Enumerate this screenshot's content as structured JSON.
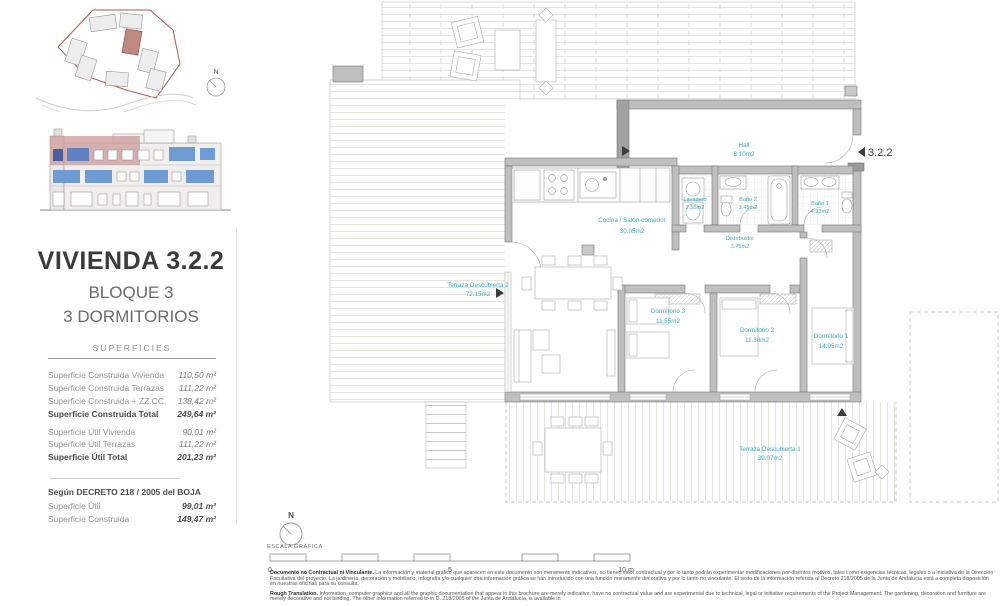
{
  "header": {
    "title": "VIVIENDA 3.2.2",
    "block": "BLOQUE 3",
    "bedrooms": "3 DORMITORIOS"
  },
  "superficies": {
    "heading": "SUPERFICIES",
    "construida": [
      {
        "label": "Superficie Construida Vivienda",
        "value": "110,50 m²"
      },
      {
        "label": "Superficie Construida Terrazas",
        "value": "111,22 m²"
      },
      {
        "label": "Superficie Construida + ZZ.CC.",
        "value": "138,42 m²"
      },
      {
        "label": "Superficie Construida Total",
        "value": "249,64 m²"
      }
    ],
    "util": [
      {
        "label": "Superficie Útil Vivienda",
        "value": "90,01 m²"
      },
      {
        "label": "Superficie Útil Terrazas",
        "value": "111,22 m²"
      },
      {
        "label": "Superficie Útil Total",
        "value": "201,23 m²"
      }
    ]
  },
  "decreto": {
    "heading": "Según DECRETO 218 / 2005 del BOJA",
    "rows": [
      {
        "label": "Superficie Útil",
        "value": "99,01 m²"
      },
      {
        "label": "Superficie Construida",
        "value": "149,47 m²"
      }
    ]
  },
  "plan": {
    "unit_marker": "3.2.2",
    "rooms": [
      {
        "name": "Terraza Descubierta 2",
        "area": "72.15m2"
      },
      {
        "name": "Cocina / Salón-comedor",
        "area": "30.05m2"
      },
      {
        "name": "Hall",
        "area": "8.10m2"
      },
      {
        "name": "Lavadero",
        "area": "2.55m2"
      },
      {
        "name": "Baño 2",
        "area": "3.45m2"
      },
      {
        "name": "Baño 1",
        "area": "4.23m2"
      },
      {
        "name": "Distribuidor",
        "area": "3.75m2"
      },
      {
        "name": "Dormitorio 3",
        "area": "11.55m2"
      },
      {
        "name": "Dormitorio 2",
        "area": "11.38m2"
      },
      {
        "name": "Dormitorio 1",
        "area": "14.95m2"
      },
      {
        "name": "Terraza Descubierta 1",
        "area": "39.07m2"
      }
    ]
  },
  "north": {
    "label": "N"
  },
  "scale": {
    "label": "ESCALA GRÁFICA",
    "t0": "0",
    "t5": "5",
    "t10": "10 m"
  },
  "footer": {
    "es_title": "Documento no Contractual ni Vinculante.",
    "es_body": " La información y material gráfico que aparecen en este documento son meramente indicativos, no tienen valor contractual y por lo tanto podrán experimentar modificaciones por distintos motivos, tales como exigencias técnicas, legales o a iniciativa de la Dirección Facultativa del proyecto. La jardinería, decoración y mobiliario, infografía y/o cualquier otra información gráfica se han introducido con una función meramente decorativa y por lo tanto no vinculante. El resto de la información referida al Decreto 218/2005 de la Junta de Andalucía está a completa disposición en nuestras oficinas para su consulta.",
    "en_title": "Rough Translation.",
    "en_body": " Information, computer graphics and all the graphic documentation that appear in this brochure are merely indicative, have no contractual value and are experimental due to technical, legal or initiative requirements of the Project Management. The gardening, decoration and furniture are merely decorative and not binding. The other information referred to in D. 218/2005 of the Junta de Andalucía, is available in"
  },
  "colors": {
    "accent_teal": "#3FA9BB",
    "site_outline_red": "#A65A50",
    "unit_highlight_pink": "#C08A82",
    "elevation_window_blue": "#6E9BD2",
    "wall_gray": "#BFBFBF"
  }
}
